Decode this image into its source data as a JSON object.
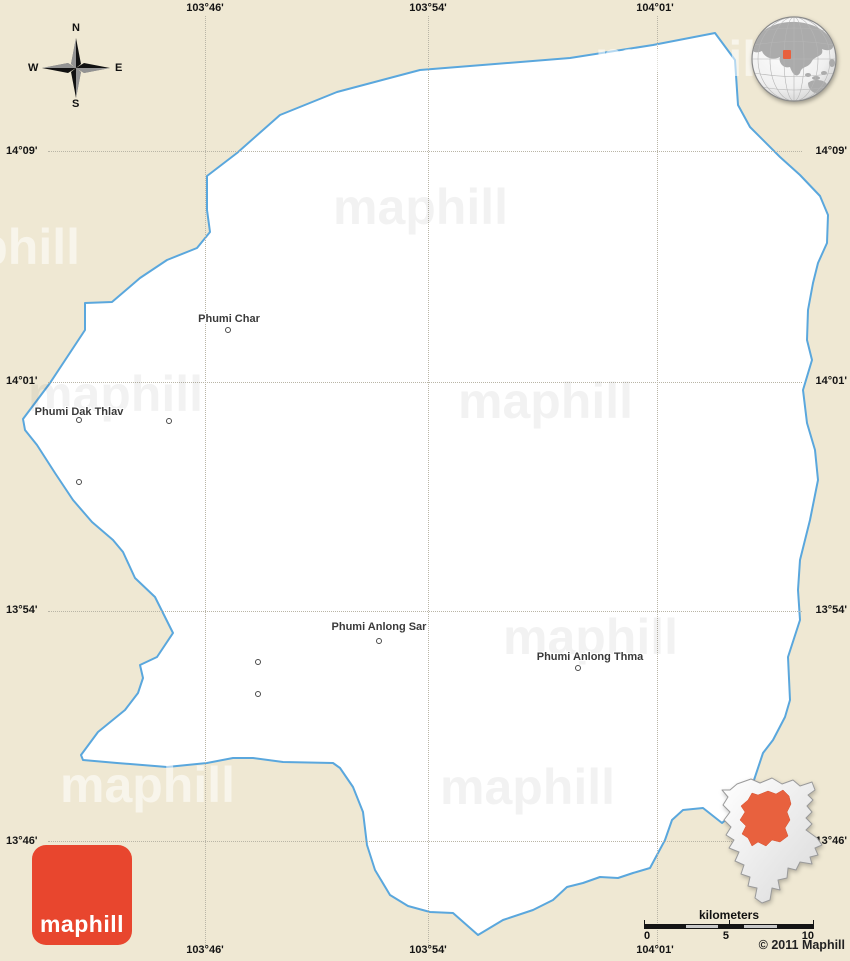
{
  "colors": {
    "background": "#efe8d3",
    "region_fill": "#ffffff",
    "boundary_blue": "#5aa7dd",
    "highlight_orange": "#e8613e",
    "logo_red": "#e8462e"
  },
  "compass": {
    "north": "N",
    "east": "E",
    "south": "S",
    "west": "W"
  },
  "grid": {
    "meridians": [
      {
        "label": "103°46'"
      },
      {
        "label": "103°54'"
      },
      {
        "label": "104°01'"
      }
    ],
    "parallels": [
      {
        "label": "14°09'"
      },
      {
        "label": "14°01'"
      },
      {
        "label": "13°54'"
      },
      {
        "label": "13°46'"
      }
    ]
  },
  "places": [
    {
      "name": "Phumi Char"
    },
    {
      "name": "Phumi Dak Thlav"
    },
    {
      "name": "Phumi Anlong Sar"
    },
    {
      "name": "Phumi Anlong Thma"
    }
  ],
  "watermark": {
    "text": "maphill"
  },
  "logo": {
    "text": "maphill"
  },
  "scalebar": {
    "title": "kilometers",
    "tick0": "0",
    "tick5": "5",
    "tick10": "10"
  },
  "copyright": "© 2011 Maphill",
  "shapes": {
    "district_outline": "715,33 735,60 738,105 750,127 780,157 800,175 820,196 828,215 827,243 818,263 813,283 808,310 807,340 812,360 803,390 807,423 815,450 818,480 810,520 800,560 798,590 800,620 788,657 790,700 785,717 773,740 763,753 753,783 748,795 735,812 722,823 703,808 683,810 672,820 665,840 650,868 633,873 618,878 600,877 583,883 567,887 553,900 533,910 503,920 478,935 453,913 430,912 408,906 390,895 375,870 367,845 363,812 353,787 340,768 333,763 283,762 253,758 233,758 207,763 167,767 117,763 83,760 81,755 98,732 125,710 138,693 143,678 140,665 157,657 173,633 155,597 135,578 123,552 113,540 92,522 73,500 55,473 37,445 25,430 23,419 50,383 85,330 85,303 112,302 140,278 167,260 197,248 210,232 207,210 207,176 237,153 280,115 337,92 420,70 570,58 653,45",
    "inset_province": "22,14 36,9 45,13 57,8 67,14 78,10 85,16 97,12 100,20 93,25 98,30 92,36 97,42 91,48 97,54 91,60 102,68 107,75 100,78 103,85 95,87 97,94 85,92 81,100 73,98 72,108 63,110 65,120 57,118 55,130 47,133 40,128 42,118 33,116 35,107 26,104 29,95 20,91 24,82 14,78 19,70 11,65 16,57 9,50 15,42 8,35 13,27 7,20 15,20",
    "inset_district": "43,25 53,21 61,24 68,20 74,26 76,34 72,42 75,50 70,58 73,66 65,72 57,70 51,76 43,72 37,76 33,68 27,64 31,56 25,50 30,42 26,36 33,30 37,23"
  }
}
